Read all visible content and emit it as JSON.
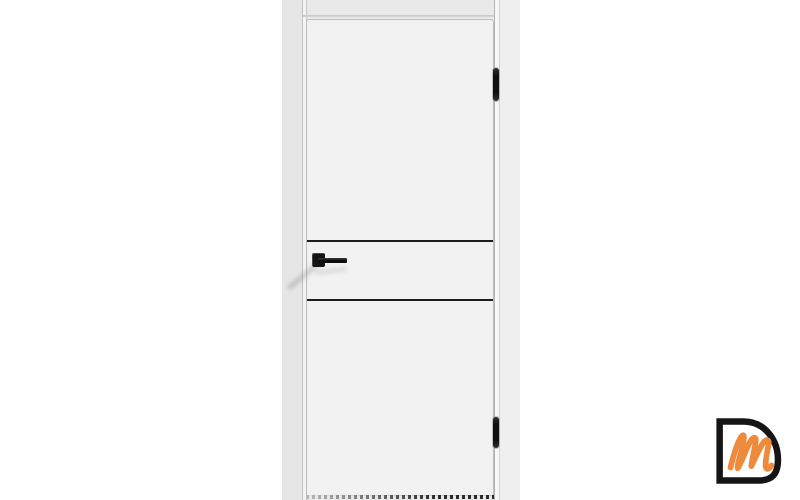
{
  "page": {
    "alt": "Product photo of a white flush interior door with two black horizontal moldings, a black square-rosette lever handle and two black hinges"
  },
  "door": {
    "accent_line_count": "2",
    "hinge_count": "2",
    "handle_style": "black lever on square rosette"
  },
  "logo": {
    "letter_outline": "D",
    "letter_script": "m",
    "alt": "DM brand logo watermark"
  },
  "theme": {
    "canvas_bg": "#ffffff",
    "photo_bg": "#e9e9e9",
    "door_leaf": "#f2f2f2",
    "accent_black": "#1d1d1d",
    "hardware_black": "#141414",
    "logo_black": "#151515",
    "logo_orange": "#ee8a3c"
  }
}
